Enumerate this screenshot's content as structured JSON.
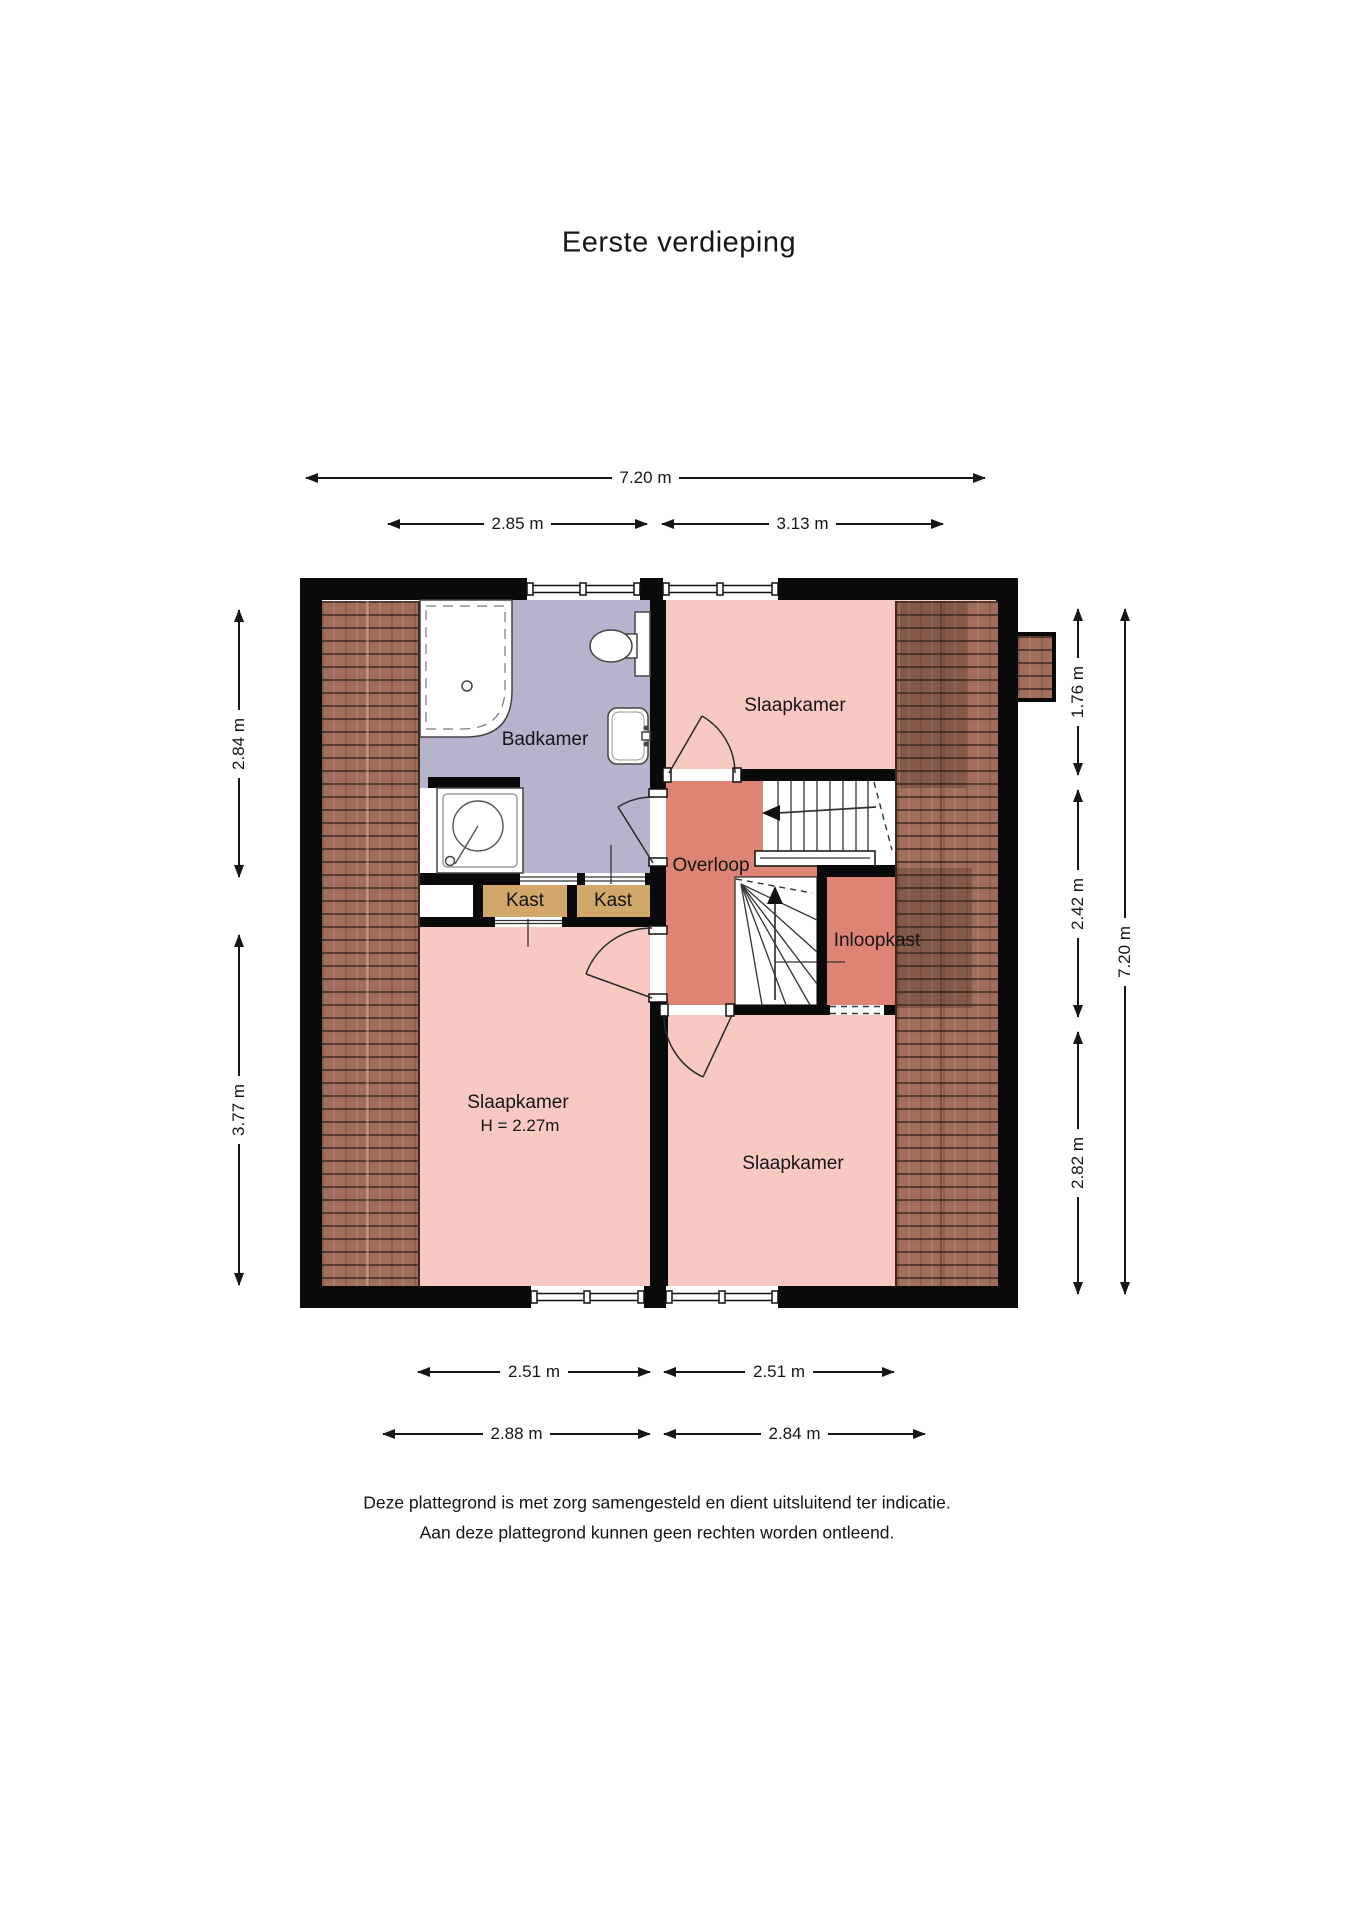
{
  "title": "Eerste verdieping",
  "rooms": {
    "badkamer": {
      "label": "Badkamer"
    },
    "slaapkamer_top": {
      "label": "Slaapkamer"
    },
    "slaapkamer_left": {
      "label": "Slaapkamer",
      "height_note": "H = 2.27m"
    },
    "slaapkamer_right": {
      "label": "Slaapkamer"
    },
    "overloop": {
      "label": "Overloop"
    },
    "kast_left": {
      "label": "Kast"
    },
    "kast_right": {
      "label": "Kast"
    },
    "inloopkast": {
      "label": "Inloopkast"
    }
  },
  "dimensions": {
    "top_total": "7.20 m",
    "top_left": "2.85 m",
    "top_right": "3.13 m",
    "left_upper": "2.84 m",
    "left_lower": "3.77 m",
    "right_upper": "1.76 m",
    "right_middle": "2.42 m",
    "right_lower": "2.82 m",
    "right_total": "7.20 m",
    "bottom_inner_left": "2.51 m",
    "bottom_inner_right": "2.51 m",
    "bottom_outer_left": "2.88 m",
    "bottom_outer_right": "2.84 m"
  },
  "disclaimer": {
    "line1": "Deze plattegrond is met zorg samengesteld en dient uitsluitend ter indicatie.",
    "line2": "Aan deze plattegrond kunnen geen rechten worden ontleend."
  },
  "colors": {
    "pink": "#f8c8c3",
    "salmon": "#dd8474",
    "lavender": "#b6b4cd",
    "tan": "#d1a76a",
    "tile": "#a06e5b",
    "wall": "#0a0a0a",
    "ink": "#161616"
  }
}
